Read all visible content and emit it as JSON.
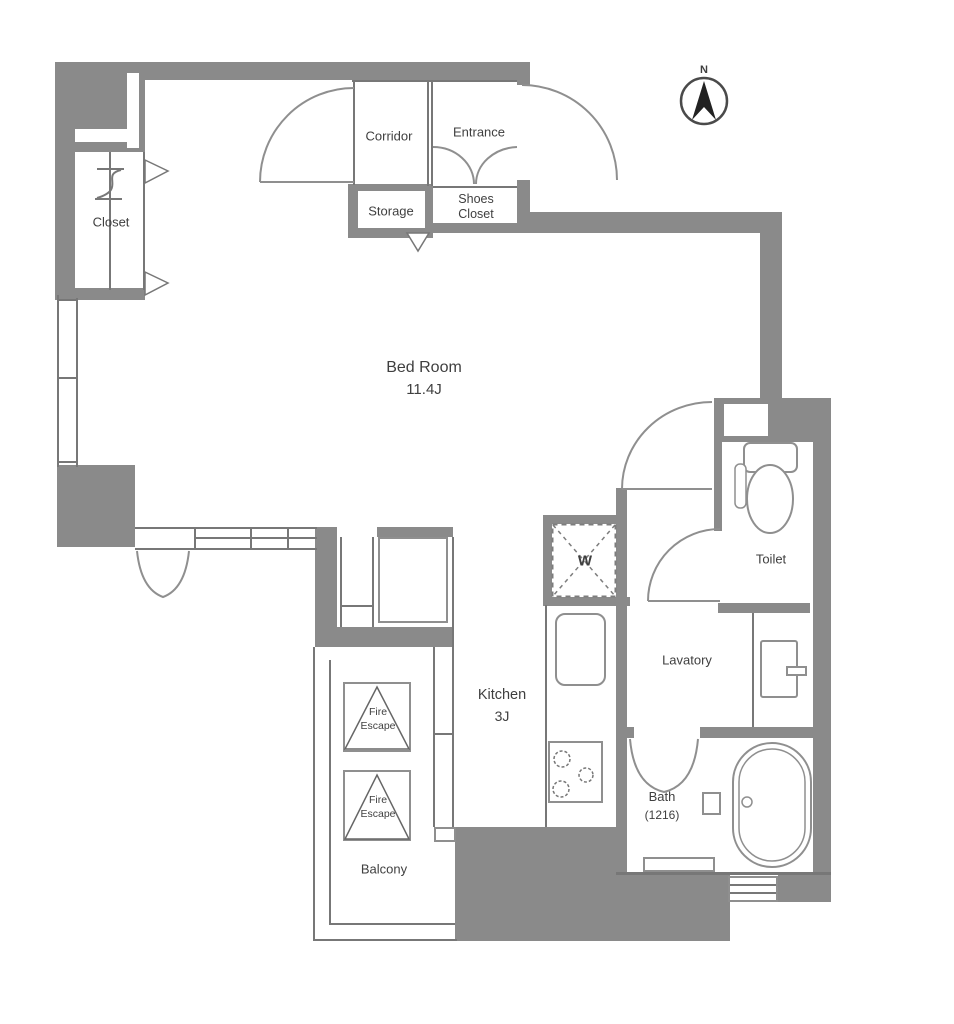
{
  "title": "Apartment floor plan",
  "compass": {
    "label": "N"
  },
  "colors": {
    "wall": "#8a8a8a",
    "line": "#777777",
    "fixture": "#8f8f8f",
    "text": "#3f3f3f",
    "background": "#ffffff"
  },
  "rooms": {
    "corridor": {
      "label": "Corridor"
    },
    "entrance": {
      "label": "Entrance"
    },
    "storage": {
      "label": "Storage"
    },
    "shoes_closet": {
      "line1": "Shoes",
      "line2": "Closet"
    },
    "closet": {
      "label": "Closet"
    },
    "bedroom": {
      "label": "Bed Room",
      "area": "11.4J"
    },
    "kitchen": {
      "label": "Kitchen",
      "area": "3J"
    },
    "lavatory": {
      "label": "Lavatory"
    },
    "toilet": {
      "label": "Toilet"
    },
    "bath": {
      "label": "Bath",
      "size": "(1216)"
    },
    "balcony": {
      "label": "Balcony"
    },
    "washing_machine": {
      "label": "W"
    },
    "fire_escape": {
      "line1": "Fire",
      "line2": "Escape"
    }
  }
}
